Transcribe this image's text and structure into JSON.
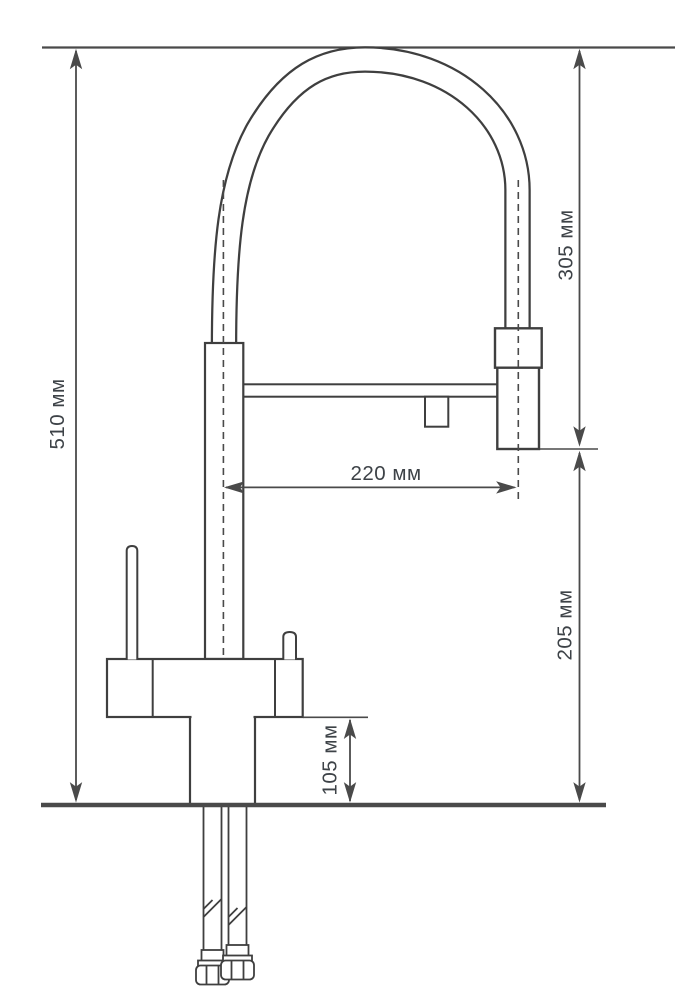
{
  "diagram": {
    "title": "Kitchen faucet technical drawing with dimensions",
    "units": "мм",
    "colors": {
      "outline": "#3f3f3f",
      "dimension_lines": "#4a4a4a",
      "label_text": "#3d4247",
      "background": "#ffffff"
    },
    "dimensions": [
      {
        "id": "overall-height",
        "label": "510 мм",
        "value": 510,
        "unit": "мм",
        "orientation": "vertical"
      },
      {
        "id": "hose-arc-height",
        "label": "305 мм",
        "value": 305,
        "unit": "мм",
        "orientation": "vertical"
      },
      {
        "id": "spout-reach",
        "label": "220 мм",
        "value": 220,
        "unit": "мм",
        "orientation": "horizontal"
      },
      {
        "id": "outlet-to-countertop",
        "label": "205 мм",
        "value": 205,
        "unit": "мм",
        "orientation": "vertical"
      },
      {
        "id": "base-height",
        "label": "105 мм",
        "value": 105,
        "unit": "мм",
        "orientation": "vertical"
      }
    ]
  }
}
